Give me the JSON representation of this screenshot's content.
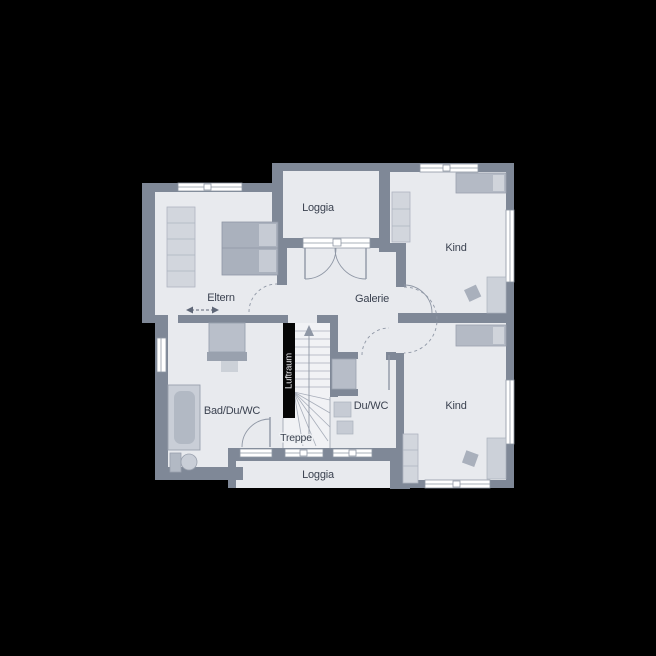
{
  "scene": {
    "type": "architectural-floor-plan",
    "background_color": "#000000"
  },
  "palette": {
    "wall": "#7f8897",
    "floor": "#e8eaee",
    "stair_floor": "#f1f2f5",
    "furniture_light": "#d2d6dd",
    "furniture_mid": "#b9bfca",
    "furniture_dark": "#99a1ae",
    "window_white": "#ffffff",
    "line": "#9aa1ad",
    "text": "#3b4250",
    "void_black": "#060606",
    "void_text": "#ededf0"
  },
  "labels": {
    "loggia_top": "Loggia",
    "kind_top": "Kind",
    "eltern": "Eltern",
    "galerie": "Galerie",
    "bad": "Bad/Du/WC",
    "du_wc": "Du/WC",
    "kind_bottom": "Kind",
    "treppe": "Treppe",
    "loggia_bottom": "Loggia",
    "luftraum": "Luftraum"
  }
}
